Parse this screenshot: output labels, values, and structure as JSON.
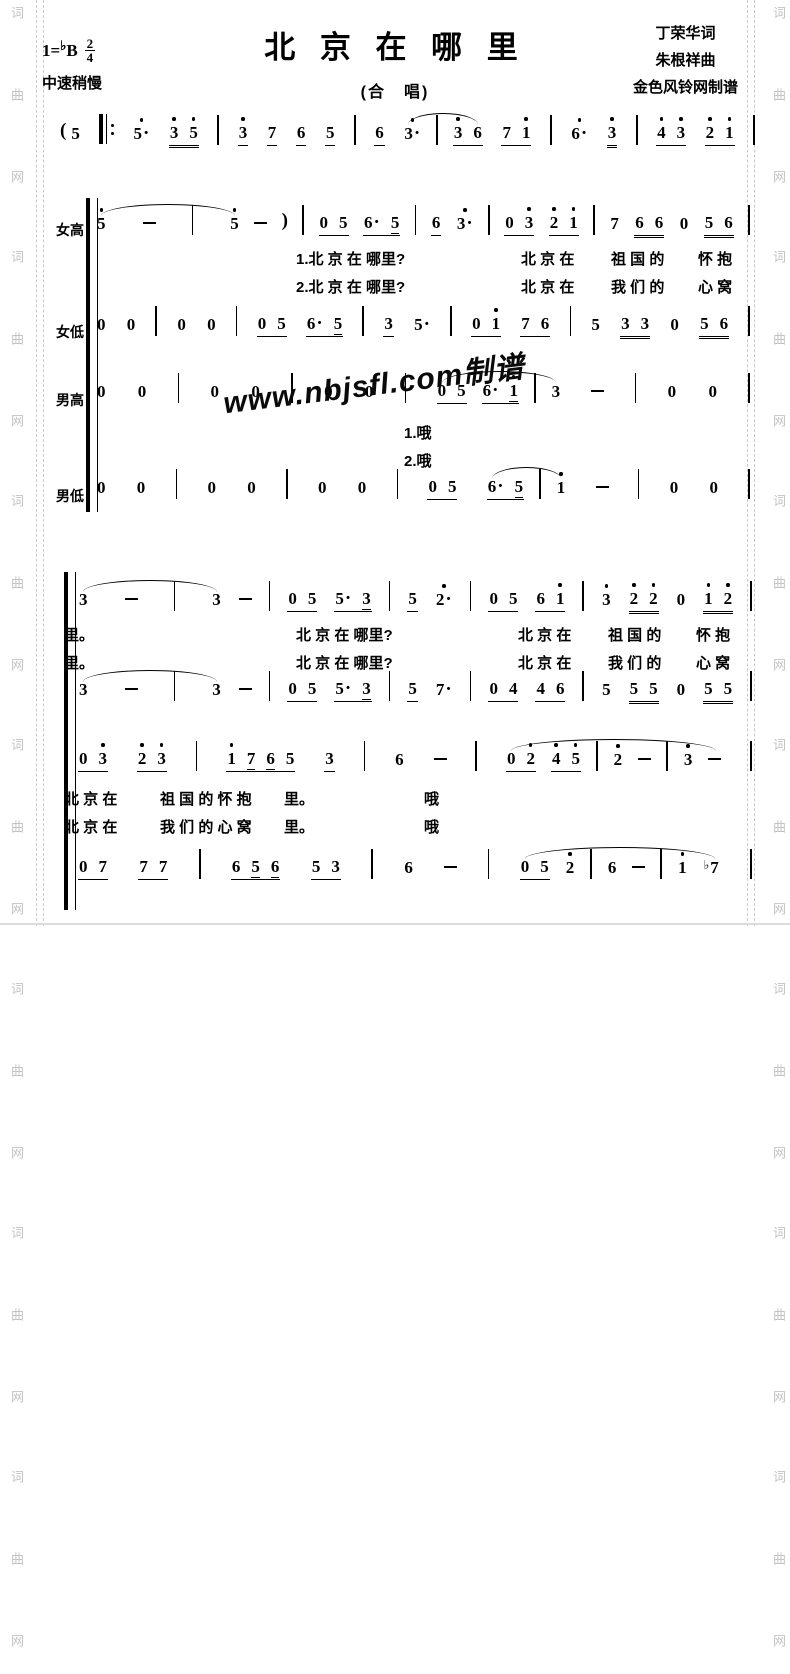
{
  "page": {
    "title": "北 京 在 哪 里",
    "subtitle": "(合　唱)",
    "key_prefix": "1=",
    "key_flat": "♭",
    "key_letter": "B",
    "meter_top": "2",
    "meter_bottom": "4",
    "tempo": "中速稍慢",
    "credits": [
      "丁荣华词",
      "朱根祥曲",
      "金色风铃网制谱"
    ]
  },
  "watermarks": {
    "side_text": "词 曲 网　词 曲 网　词 曲 网　词 曲 网　词 曲 网　词 曲 网　词 曲 网",
    "diagonal": "www.nbjsfl.com制谱"
  },
  "voice_labels": [
    "女高",
    "女低",
    "男高",
    "男低"
  ],
  "music_lines": {
    "intro": [
      {
        "g": [
          "(",
          "5"
        ]
      },
      "rpt",
      "5'.",
      {
        "b": [
          "3'",
          "5'"
        ],
        "u": 2
      },
      "|",
      {
        "b": [
          "3'"
        ],
        "u": 1
      },
      {
        "b": [
          "7"
        ],
        "u": 1
      },
      {
        "b": [
          "6"
        ],
        "u": 1
      },
      {
        "b": [
          "5"
        ],
        "u": 1
      },
      "|",
      {
        "b": [
          "6"
        ],
        "u": 1
      },
      {
        "a": [
          "3'.",
          "|",
          {
            "b": [
              "3'",
              "6"
            ],
            "u": 1
          }
        ]
      },
      {
        "b": [
          "7",
          "1'"
        ],
        "u": 1
      },
      "|",
      "6'.",
      {
        "b": [
          "3'"
        ],
        "u": 2
      },
      "|",
      {
        "b": [
          "4'",
          "3'"
        ],
        "u": 1
      },
      {
        "b": [
          "2'",
          "1'"
        ],
        "u": 1
      },
      "|"
    ],
    "s1_soprano": [
      {
        "a": [
          "5'",
          "-",
          "|",
          "5'"
        ],
        "w": 1
      },
      "-",
      ")",
      "|",
      {
        "b": [
          "0",
          "5"
        ],
        "u": 1
      },
      {
        "b": [
          "6.",
          "5_"
        ],
        "u": 1
      },
      "|",
      {
        "b": [
          "6"
        ],
        "u": 1
      },
      "3'.",
      "|",
      {
        "b": [
          "0",
          "3'"
        ],
        "u": 1
      },
      {
        "b": [
          "2'",
          "1'"
        ],
        "u": 1
      },
      "|",
      "7",
      {
        "b": [
          "6",
          "6"
        ],
        "u": 2
      },
      "0",
      {
        "b": [
          "5",
          "6"
        ],
        "u": 2
      },
      "|"
    ],
    "s1_alto": [
      "0",
      "0",
      "|",
      "0",
      "0",
      "|",
      {
        "b": [
          "0",
          "5"
        ],
        "u": 1
      },
      {
        "b": [
          "6.",
          "5_"
        ],
        "u": 1
      },
      "|",
      {
        "b": [
          "3"
        ],
        "u": 1
      },
      "5.",
      "|",
      {
        "b": [
          "0",
          "1'"
        ],
        "u": 1
      },
      {
        "b": [
          "7",
          "6"
        ],
        "u": 1
      },
      "|",
      "5",
      {
        "b": [
          "3",
          "3"
        ],
        "u": 2
      },
      "0",
      {
        "b": [
          "5",
          "6"
        ],
        "u": 2
      },
      "|"
    ],
    "s1_tenor": [
      "0",
      "0",
      "|",
      "0",
      "0",
      "|",
      "0",
      "0",
      "|",
      {
        "a": [
          {
            "b": [
              "0",
              "5"
            ],
            "u": 1
          },
          {
            "b": [
              "6.",
              "1'_"
            ],
            "u": 1
          },
          "|",
          "3"
        ]
      },
      "-",
      "|",
      "0",
      "0",
      "|"
    ],
    "s1_bass": [
      "0",
      "0",
      "|",
      "0",
      "0",
      "|",
      "0",
      "0",
      "|",
      {
        "b": [
          "0",
          "5"
        ],
        "u": 1
      },
      {
        "a": [
          {
            "b": [
              "6.",
              "5_"
            ],
            "u": 1
          },
          "|",
          "1'"
        ]
      },
      "-",
      "|",
      "0",
      "0",
      "|"
    ],
    "s2_line1": [
      {
        "a": [
          "3",
          "-",
          "|",
          "3"
        ],
        "w": 1
      },
      "-",
      "|",
      {
        "b": [
          "0",
          "5"
        ],
        "u": 1
      },
      {
        "b": [
          "5.",
          "3_"
        ],
        "u": 1
      },
      "|",
      {
        "b": [
          "5"
        ],
        "u": 1
      },
      "2'.",
      "|",
      {
        "b": [
          "0",
          "5"
        ],
        "u": 1
      },
      {
        "b": [
          "6",
          "1'"
        ],
        "u": 1
      },
      "|",
      "3'",
      {
        "b": [
          "2'",
          "2'"
        ],
        "u": 2
      },
      "0",
      {
        "b": [
          "1'",
          "2'"
        ],
        "u": 2
      },
      "|"
    ],
    "s2_line2": [
      {
        "a": [
          "3",
          "-",
          "|",
          "3"
        ],
        "w": 1
      },
      "-",
      "|",
      {
        "b": [
          "0",
          "5"
        ],
        "u": 1
      },
      {
        "b": [
          "5.",
          "3_"
        ],
        "u": 1
      },
      "|",
      {
        "b": [
          "5"
        ],
        "u": 1
      },
      "7.",
      "|",
      {
        "b": [
          "0",
          "4"
        ],
        "u": 1
      },
      {
        "b": [
          "4",
          "6"
        ],
        "u": 1
      },
      "|",
      "5",
      {
        "b": [
          "5",
          "5"
        ],
        "u": 2
      },
      "0",
      {
        "b": [
          "5",
          "5"
        ],
        "u": 2
      },
      "|"
    ],
    "s2_line3": [
      {
        "b": [
          "0",
          "3'"
        ],
        "u": 1
      },
      {
        "b": [
          "2'",
          "3'"
        ],
        "u": 1
      },
      "|",
      {
        "b": [
          "1'",
          "7_",
          "6_",
          "5"
        ],
        "u": 1
      },
      {
        "b": [
          "3"
        ],
        "u": 1
      },
      "|",
      "6",
      "-",
      "|",
      {
        "a": [
          {
            "b": [
              "0",
              "2'"
            ],
            "u": 1
          },
          {
            "b": [
              "4'",
              "5'"
            ],
            "u": 1
          },
          "|",
          "2'",
          "-",
          "|",
          "3'",
          "-"
        ]
      },
      "|"
    ],
    "s2_line4": [
      {
        "b": [
          "0",
          "7"
        ],
        "u": 1
      },
      {
        "b": [
          "7",
          "7"
        ],
        "u": 1
      },
      "|",
      {
        "b": [
          "6",
          "5_",
          "6_"
        ],
        "u": 1
      },
      {
        "b": [
          "5",
          "3"
        ],
        "u": 1
      },
      "|",
      "6",
      "-",
      "|",
      {
        "a": [
          {
            "b": [
              "0",
              "5"
            ],
            "u": 1
          },
          "2'",
          "|",
          "6",
          "-",
          "|",
          "1'",
          "b7"
        ]
      },
      "|"
    ]
  },
  "lyrics": {
    "s1_r1": [
      "1.北 京 在 哪里?",
      "北 京 在",
      "祖 国 的",
      "怀 抱"
    ],
    "s1_r2": [
      "2.北 京 在 哪里?",
      "北 京 在",
      "我 们 的",
      "心 窝"
    ],
    "tenor_r1": [
      "1.哦"
    ],
    "tenor_r2": [
      "2.哦"
    ],
    "s2_r1": [
      "里。",
      "北 京 在 哪里?",
      "北 京 在",
      "祖 国 的",
      "怀 抱"
    ],
    "s2_r2": [
      "里。",
      "北 京 在 哪里?",
      "北 京 在",
      "我 们 的",
      "心 窝"
    ],
    "l3_r1": [
      "北 京 在",
      "祖 国 的 怀 抱",
      "里。",
      "哦"
    ],
    "l3_r2": [
      "北 京 在",
      "我 们 的 心 窝",
      "里。",
      "哦"
    ]
  }
}
